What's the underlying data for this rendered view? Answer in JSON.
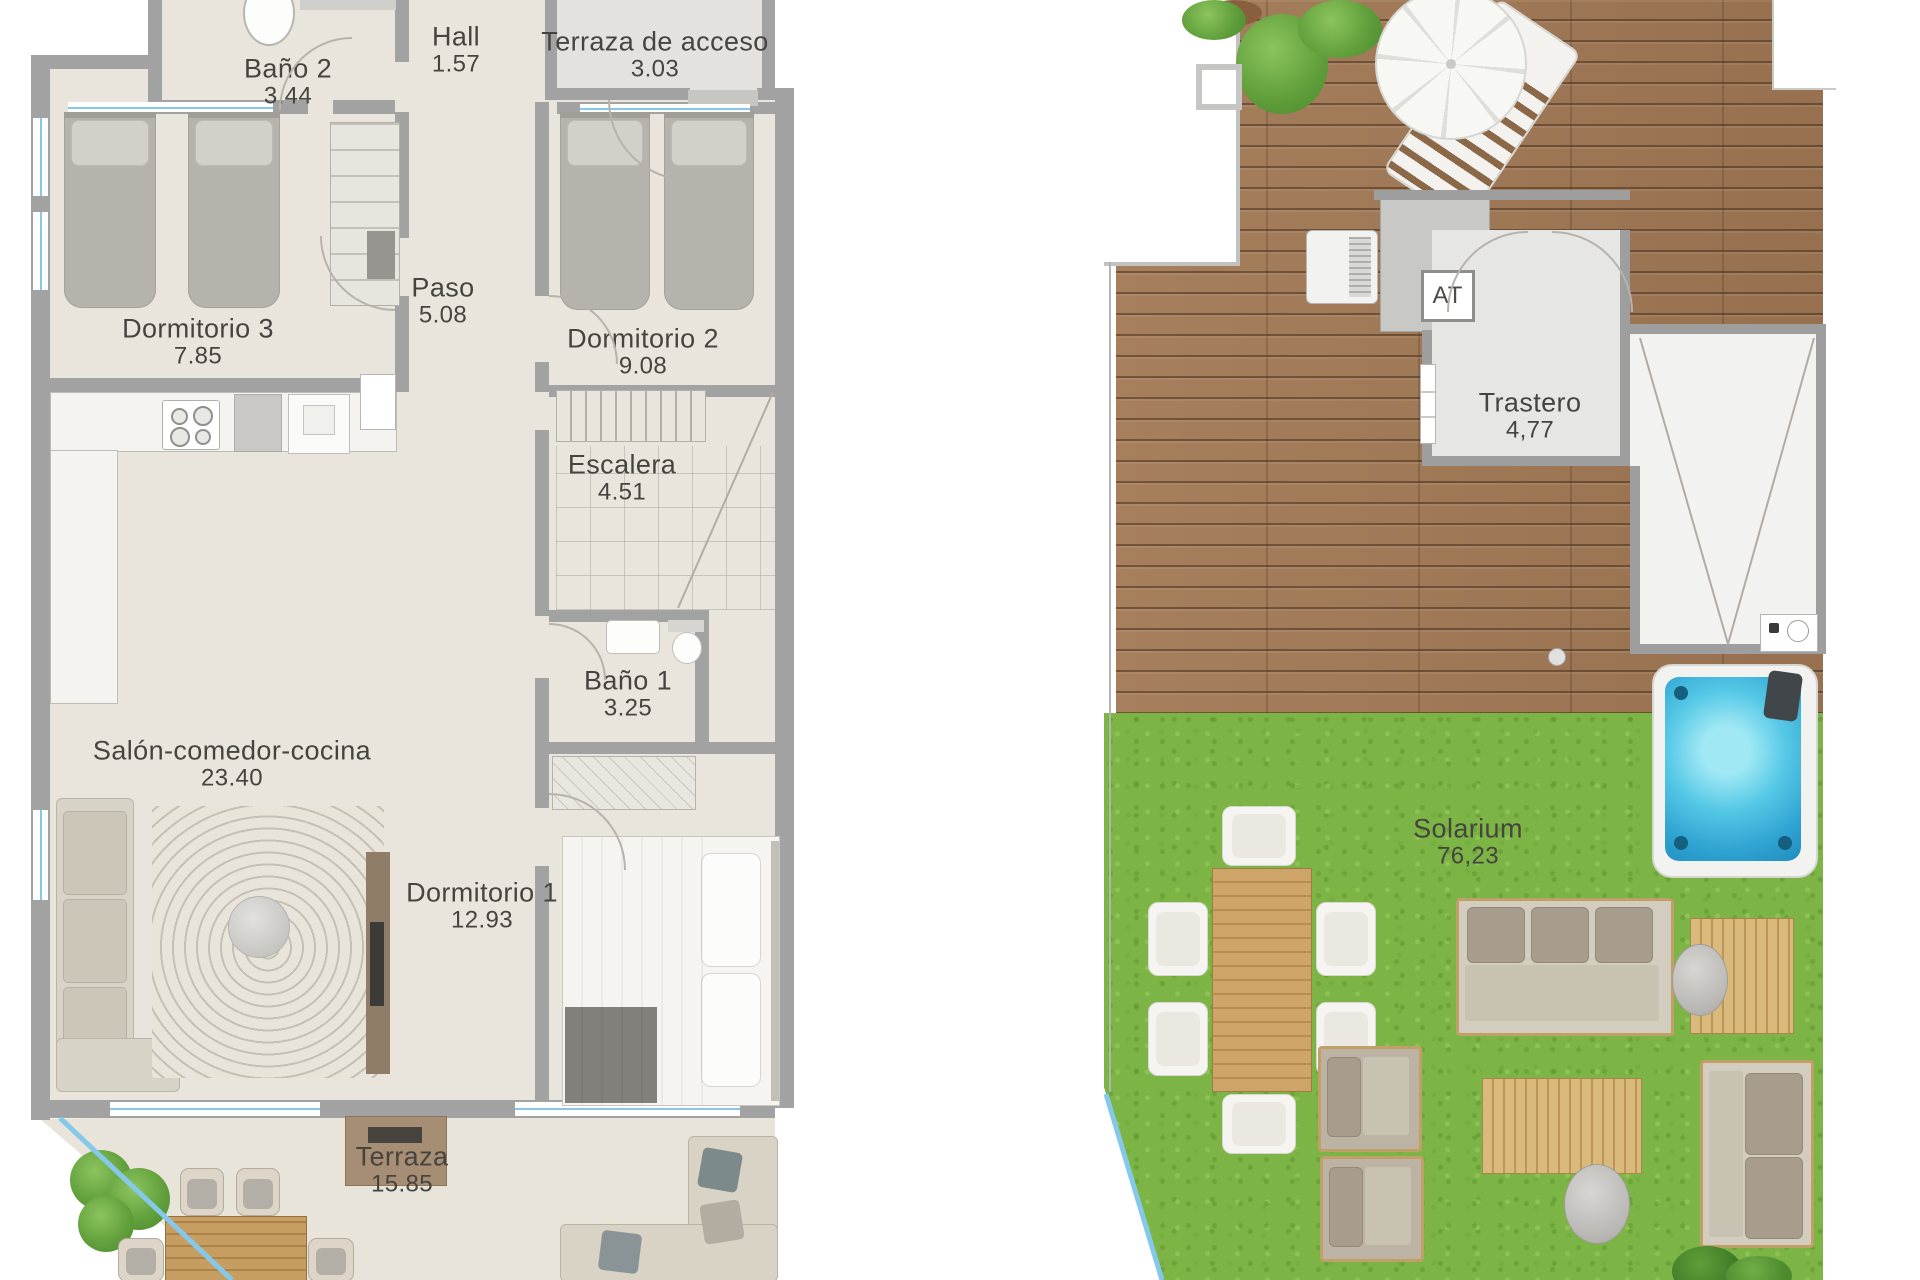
{
  "left_panel": {
    "bano2": {
      "name": "Baño 2",
      "area": "3.44"
    },
    "hall": {
      "name": "Hall",
      "area": "1.57"
    },
    "terraza_acceso": {
      "name": "Terraza de acceso",
      "area": "3.03"
    },
    "dormitorio3": {
      "name": "Dormitorio 3",
      "area": "7.85"
    },
    "paso": {
      "name": "Paso",
      "area": "5.08"
    },
    "dormitorio2": {
      "name": "Dormitorio 2",
      "area": "9.08"
    },
    "escalera": {
      "name": "Escalera",
      "area": "4.51"
    },
    "bano1": {
      "name": "Baño 1",
      "area": "3.25"
    },
    "salon": {
      "name": "Salón-comedor-cocina",
      "area": "23.40"
    },
    "dormitorio1": {
      "name": "Dormitorio 1",
      "area": "12.93"
    },
    "terraza": {
      "name": "Terraza",
      "area": "15.85"
    }
  },
  "right_panel": {
    "at_label": "AT",
    "trastero": {
      "name": "Trastero",
      "area": "4,77"
    },
    "solarium": {
      "name": "Solarium",
      "area": "76,23"
    }
  },
  "colors": {
    "floor_cream": "#eae5dc",
    "wall_gray": "#a2a2a2",
    "deck_wood": "#a07a58",
    "grass_green": "#7cb445",
    "water_blue": "#3cb4dc",
    "glazing_blue": "#85c8ea",
    "label_text": "#45443f"
  }
}
